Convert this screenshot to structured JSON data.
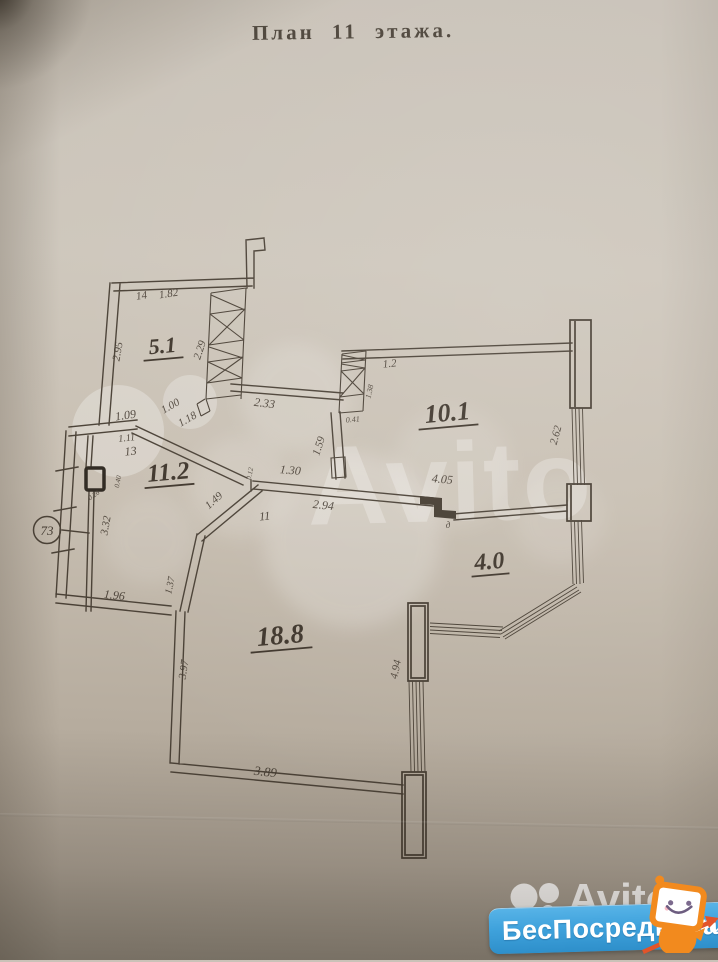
{
  "title": "План  11  этажа.",
  "watermark": {
    "brand": "Avito",
    "badge": "БесПосредника",
    "badge_suffix": ".ru"
  },
  "plan": {
    "apartment_badge": "73",
    "rooms": [
      {
        "t": "5.1",
        "x": 163,
        "y": 353,
        "r": -5,
        "fs": 22,
        "uw": 40
      },
      {
        "t": "11.2",
        "x": 169,
        "y": 480,
        "r": -5,
        "fs": 25,
        "uw": 50
      },
      {
        "t": "10.1",
        "x": 448,
        "y": 421,
        "r": -5,
        "fs": 26,
        "uw": 60
      },
      {
        "t": "4.0",
        "x": 490,
        "y": 569,
        "r": -5,
        "fs": 24,
        "uw": 38
      },
      {
        "t": "18.8",
        "x": 281,
        "y": 644,
        "r": -5,
        "fs": 27,
        "uw": 62
      }
    ],
    "dimensions": [
      {
        "t": "14",
        "x": 142,
        "y": 299,
        "r": -8,
        "fs": 11
      },
      {
        "t": "1.82",
        "x": 169,
        "y": 297,
        "r": -8,
        "fs": 11
      },
      {
        "t": "2.95",
        "x": 121,
        "y": 352,
        "r": -80,
        "fs": 11
      },
      {
        "t": "2.29",
        "x": 203,
        "y": 351,
        "r": -72,
        "fs": 11
      },
      {
        "t": "1.09",
        "x": 126,
        "y": 419,
        "r": -8,
        "fs": 12
      },
      {
        "t": "1.00",
        "x": 172,
        "y": 409,
        "r": -30,
        "fs": 11
      },
      {
        "t": "1.18",
        "x": 189,
        "y": 422,
        "r": -30,
        "fs": 11
      },
      {
        "t": "1.11",
        "x": 127,
        "y": 441,
        "r": -6,
        "fs": 10
      },
      {
        "t": "13",
        "x": 131,
        "y": 455,
        "r": -6,
        "fs": 12
      },
      {
        "t": "2.33",
        "x": 264,
        "y": 407,
        "r": 7,
        "fs": 12
      },
      {
        "t": "1.2",
        "x": 390,
        "y": 367,
        "r": -6,
        "fs": 11
      },
      {
        "t": "1.38",
        "x": 372,
        "y": 392,
        "r": -78,
        "fs": 8
      },
      {
        "t": "0.41",
        "x": 353,
        "y": 422,
        "r": -5,
        "fs": 8
      },
      {
        "t": "2.62",
        "x": 559,
        "y": 436,
        "r": -75,
        "fs": 11
      },
      {
        "t": "1.59",
        "x": 322,
        "y": 447,
        "r": -72,
        "fs": 11
      },
      {
        "t": "1.30",
        "x": 290,
        "y": 474,
        "r": 5,
        "fs": 12
      },
      {
        "t": "0.12",
        "x": 252,
        "y": 474,
        "r": -78,
        "fs": 7
      },
      {
        "t": "2.94",
        "x": 323,
        "y": 509,
        "r": 6,
        "fs": 12
      },
      {
        "t": "11",
        "x": 265,
        "y": 520,
        "r": -5,
        "fs": 12
      },
      {
        "t": "4.05",
        "x": 442,
        "y": 483,
        "r": 5,
        "fs": 12
      },
      {
        "t": "д",
        "x": 448,
        "y": 528,
        "r": 0,
        "fs": 9
      },
      {
        "t": "1.49",
        "x": 216,
        "y": 503,
        "r": -42,
        "fs": 11
      },
      {
        "t": "3.32",
        "x": 109,
        "y": 526,
        "r": -80,
        "fs": 11
      },
      {
        "t": "0.40",
        "x": 120,
        "y": 482,
        "r": -80,
        "fs": 7
      },
      {
        "t": "0.26",
        "x": 95,
        "y": 497,
        "r": -35,
        "fs": 7
      },
      {
        "t": "1.96",
        "x": 114,
        "y": 599,
        "r": 6,
        "fs": 12
      },
      {
        "t": "1.37",
        "x": 173,
        "y": 586,
        "r": -78,
        "fs": 10
      },
      {
        "t": "3.97",
        "x": 187,
        "y": 670,
        "r": -82,
        "fs": 11
      },
      {
        "t": "3.89",
        "x": 265,
        "y": 776,
        "r": 6,
        "fs": 13
      },
      {
        "t": "4.94",
        "x": 399,
        "y": 670,
        "r": -78,
        "fs": 11
      }
    ]
  },
  "colors": {
    "ink": "#4a4136",
    "paper_top": "#c9c2b8",
    "paper_bottom": "#928a7d",
    "badge_blue": "#3fa2dc",
    "mascot_orange": "#f28a1e",
    "watermark_white": "#ffffff"
  }
}
